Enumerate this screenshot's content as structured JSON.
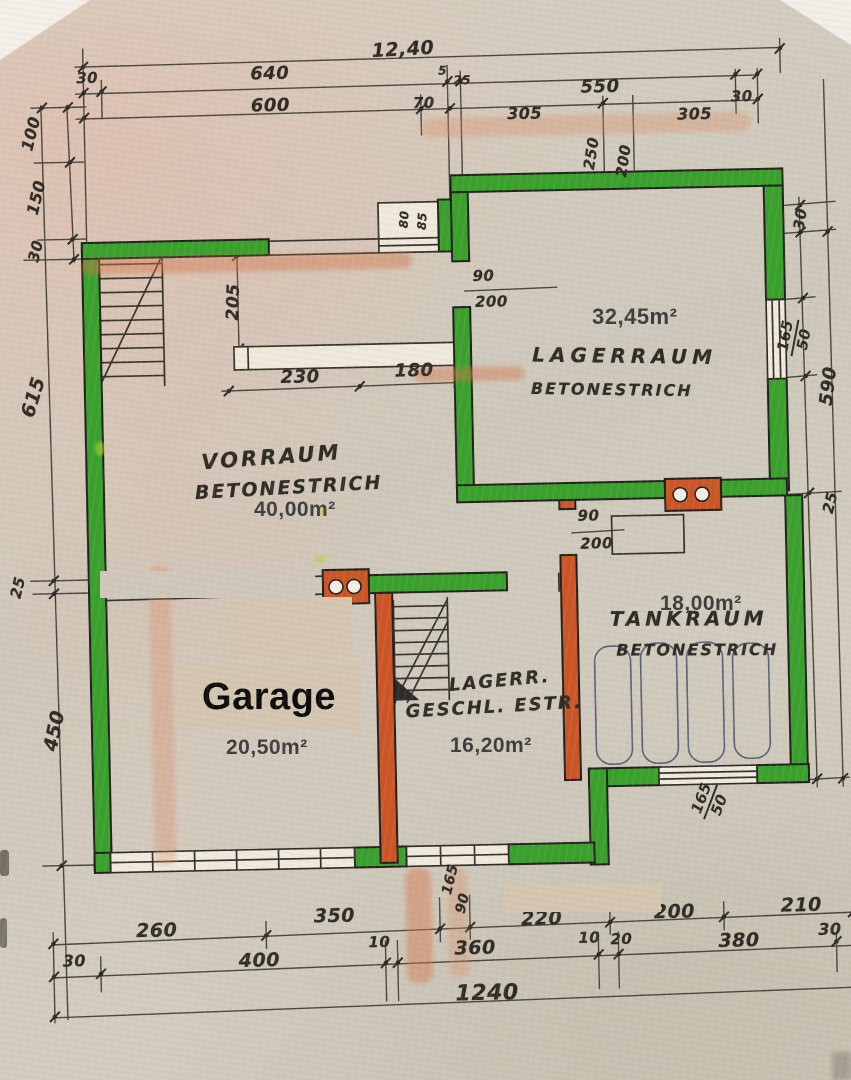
{
  "rooms": {
    "vorraum": {
      "name": "VORRAUM",
      "floor": "BETONESTRICH",
      "area": "40,00m²"
    },
    "lagerraum": {
      "name": "LAGERRAUM",
      "floor": "BETONESTRICH",
      "area": "32,45m²"
    },
    "tankraum": {
      "name": "TANKRAUM",
      "floor": "BETONESTRICH",
      "area": "18,00m²"
    },
    "lager_geschl": {
      "name": "LAGERR.",
      "floor": "GESCHL. ESTR.",
      "area": "16,20m²"
    },
    "garage": {
      "name": "Garage",
      "area": "20,50m²",
      "note": "TÜ"
    }
  },
  "dims": {
    "top_total": "12,40",
    "top_30_left": "30",
    "top_640": "640",
    "top_600": "600",
    "top_70": "70",
    "top_5": "5",
    "top_25": "25",
    "top_550": "550",
    "top_305_a": "305",
    "top_305_b": "305",
    "top_30_right": "30",
    "setback_250": "250",
    "setback_200": "200",
    "left_100": "100",
    "left_150": "150",
    "left_30": "30",
    "left_615": "615",
    "left_25": "25",
    "left_450": "450",
    "right_30": "30",
    "right_win_165": "165",
    "right_win_50": "50",
    "right_590": "590",
    "right_25": "25",
    "mid_205": "205",
    "mid_230": "230",
    "mid_180": "180",
    "door1_90": "90",
    "door1_200": "200",
    "niche_80": "80",
    "niche_85": "85",
    "door2_90": "90",
    "door2_200": "200",
    "bot_165": "165",
    "bot_90": "90",
    "botwin_165": "165",
    "botwin_50": "50",
    "b1_260": "260",
    "b1_350": "350",
    "b1_220": "220",
    "b1_200": "200",
    "b1_210": "210",
    "b2_30_left": "30",
    "b2_400": "400",
    "b2_10_a": "10",
    "b2_360": "360",
    "b2_10_b": "10",
    "b2_20": "20",
    "b2_380": "380",
    "b2_30_right": "30",
    "b3_total": "1240"
  }
}
